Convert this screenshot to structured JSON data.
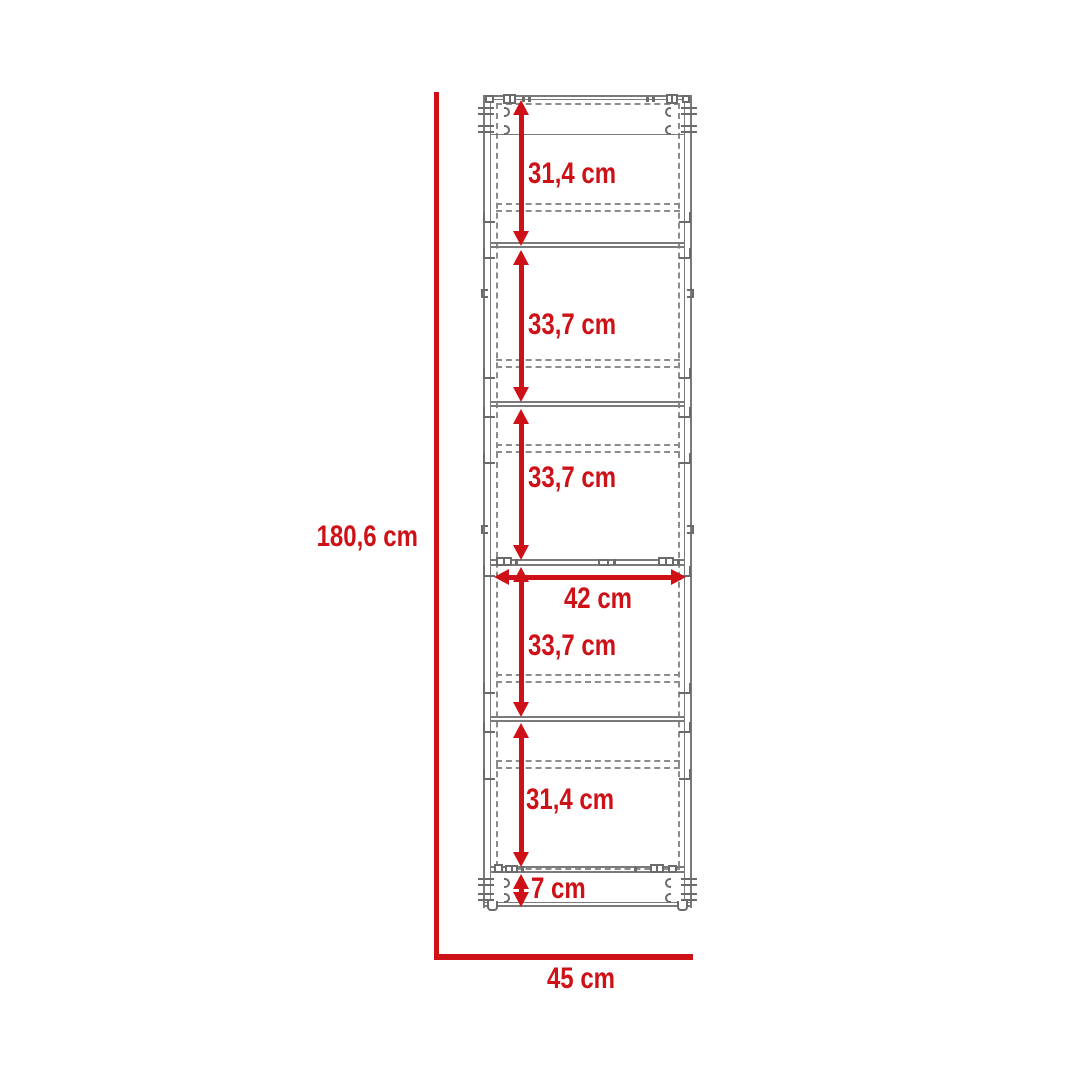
{
  "colors": {
    "accent_red": "#CE1117",
    "drawing_gray": "#7A7A7A"
  },
  "diagram": {
    "dimensions": {
      "total_height": "180,6 cm",
      "total_width": "45 cm",
      "inner_width": "42 cm",
      "base_height": "7 cm",
      "sections": [
        "31,4 cm",
        "33,7 cm",
        "33,7 cm",
        "33,7 cm",
        "31,4 cm"
      ]
    }
  }
}
